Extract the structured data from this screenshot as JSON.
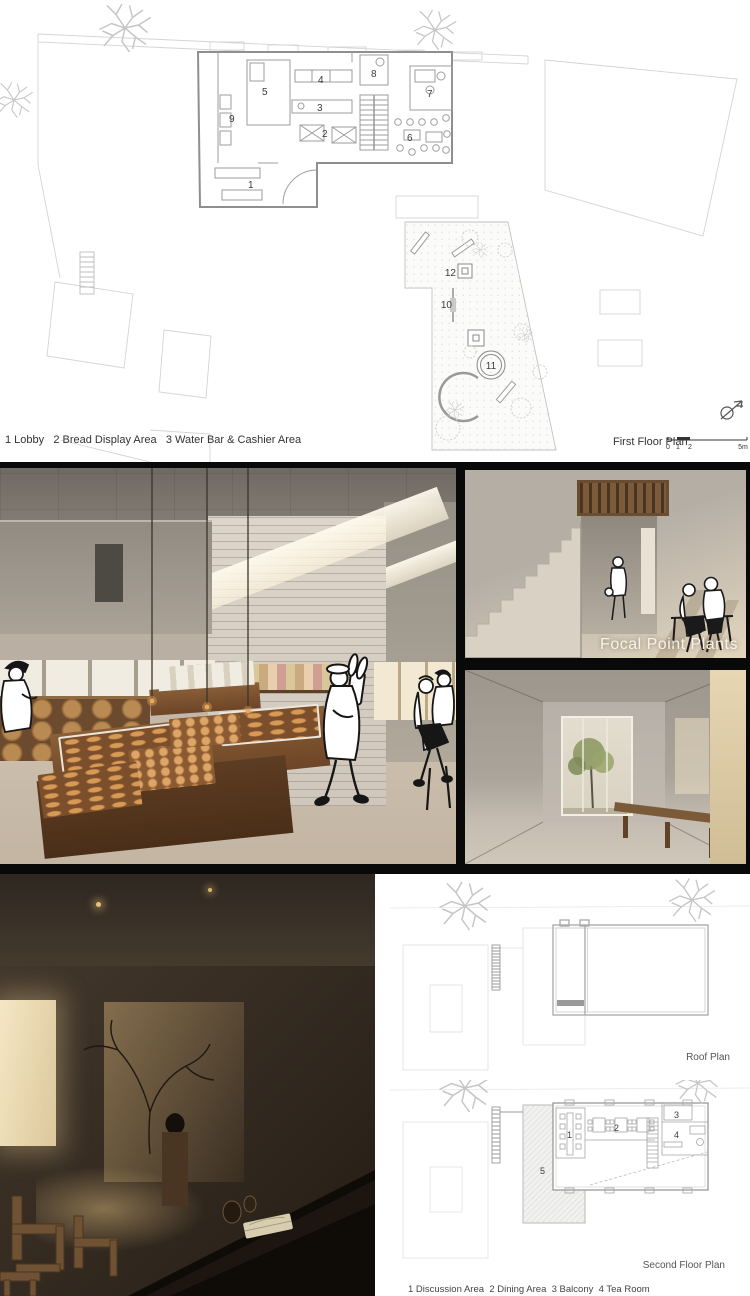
{
  "colors": {
    "band_black": "#090909",
    "wood_accent": "#7a5636",
    "bread": "#c98b4e",
    "caption_white": "#f6f3ec",
    "plan_line_gray": "#9a9a9a"
  },
  "first_floor": {
    "plan_label": "First Floor Plan",
    "legend_lines": [
      "1 Lobby   2 Bread Display Area   3 Water Bar & Cashier Area",
      "4 Open Kitchen Area   5 Back Kitchen   6 Dining Area",
      "7 Rest Area   8 Power Distribution Room   9 Ice Cream Area",
      "10 Swing   11Trampoline   12Existing Utility Pole"
    ],
    "rooms": [
      "1",
      "2",
      "3",
      "4",
      "5",
      "6",
      "7",
      "8",
      "9",
      "10",
      "11",
      "12"
    ],
    "scale_ticks": [
      "0",
      "1",
      "2",
      "5m"
    ]
  },
  "renders": {
    "caption": "Focal Point Plants"
  },
  "roof_plan": {
    "label": "Roof Plan"
  },
  "second_floor": {
    "label": "Second Floor Plan",
    "legend_lines": [
      "1 Discussion Area  2 Dining Area  3 Balcony  4 Tea Room",
      "5 Rooftop Terrace"
    ],
    "rooms": [
      "1",
      "2",
      "3",
      "4",
      "5"
    ]
  }
}
